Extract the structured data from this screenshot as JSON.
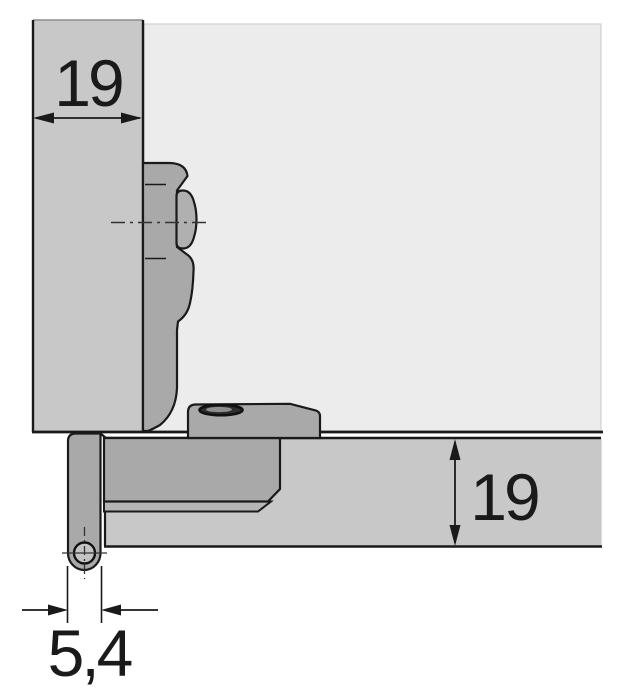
{
  "diagram": {
    "type": "technical-cross-section",
    "subject": "concealed-hinge-mounting",
    "dimensions": {
      "panel_thickness": "19",
      "door_thickness": "19",
      "pivot_offset": "5,4"
    },
    "colors": {
      "panel_fill": "#c8c8c8",
      "interior_fill": "#ececec",
      "hardware_fill": "#a9a9a9",
      "hardware_light": "#b5b5b5",
      "screw_head_fill": "#b0b0b0",
      "hole_fill": "#2f2f2f",
      "pin_fill": "#c4c4c4",
      "outline": "#1a1a1a"
    }
  }
}
